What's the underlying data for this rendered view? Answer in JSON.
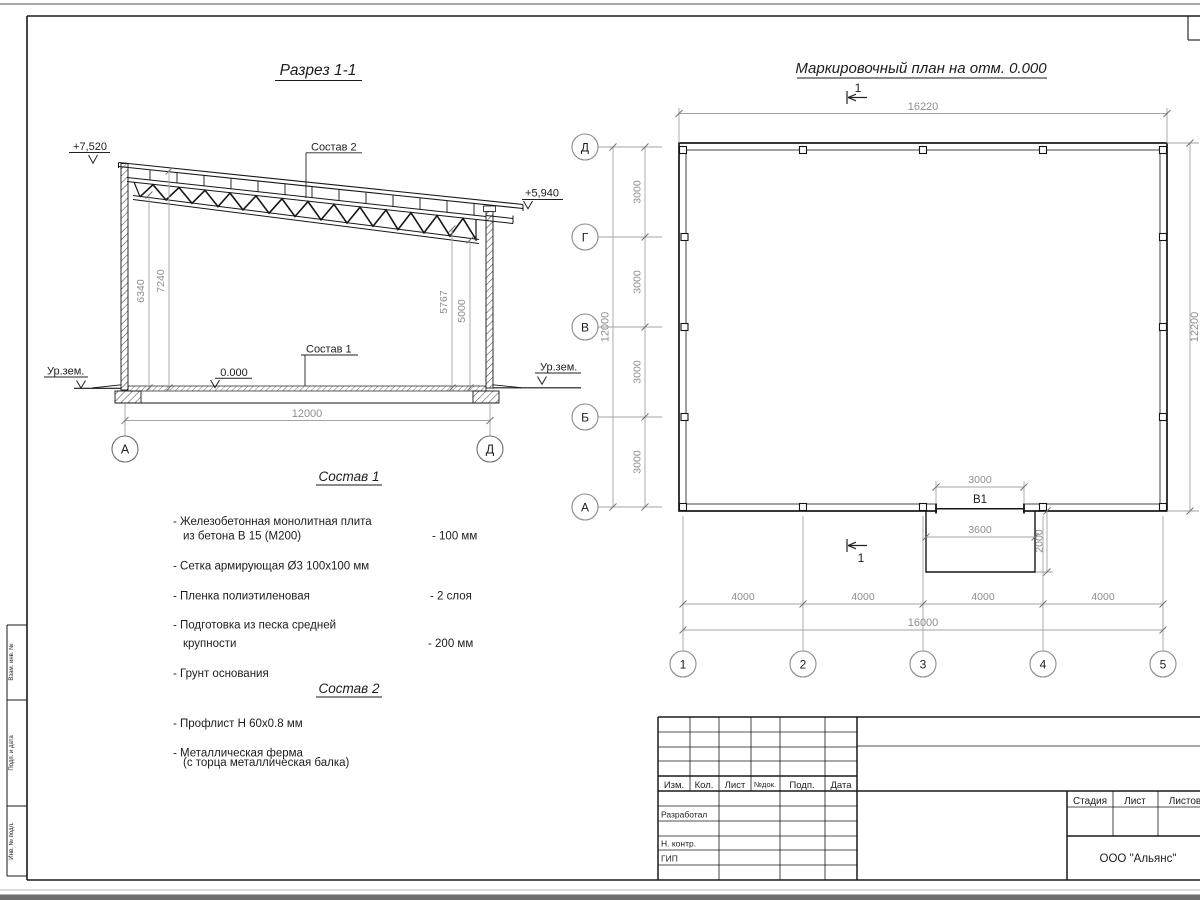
{
  "section_view": {
    "title": "Разрез 1-1",
    "level_top_left": "+7,520",
    "level_top_right": "+5,940",
    "level_floor": "0.000",
    "ground_label_left": "Ур.зем.",
    "ground_label_right": "Ур.зем.",
    "callout_roof": "Состав 2",
    "callout_floor": "Состав 1",
    "dim_h_left_1": "6340",
    "dim_h_left_2": "7240",
    "dim_h_right_1": "5767",
    "dim_h_right_2": "5000",
    "dim_span": "12000",
    "axis_left": "А",
    "axis_right": "Д"
  },
  "plan_view": {
    "title": "Маркировочный план на отм. 0.000",
    "section_mark_top": "1",
    "section_mark_bottom": "1",
    "dim_top_total": "16220",
    "dim_right_total": "12200",
    "dim_left_total": "12000",
    "dim_bottom_total": "16000",
    "row_axes": [
      "Д",
      "Г",
      "В",
      "Б",
      "А"
    ],
    "col_axes": [
      "1",
      "2",
      "3",
      "4",
      "5"
    ],
    "row_steps": [
      "3000",
      "3000",
      "3000",
      "3000"
    ],
    "col_steps": [
      "4000",
      "4000",
      "4000",
      "4000"
    ],
    "opening_label": "В1",
    "opening_dim": "3000",
    "porch_width": "3600",
    "porch_depth": "2000"
  },
  "notes": {
    "composition1": {
      "title": "Состав 1",
      "items": [
        {
          "line1": "- Железобетонная  монолитная плита",
          "line2": "из бетона В 15 (М200)",
          "value": "- 100 мм"
        },
        {
          "line1": "- Сетка армирующая Ø3 100х100 мм",
          "line2": "",
          "value": ""
        },
        {
          "line1": "- Пленка полиэтиленовая",
          "line2": "",
          "value": "-  2 слоя"
        },
        {
          "line1": "- Подготовка из песка средней",
          "line2": "крупности",
          "value": "- 200 мм"
        },
        {
          "line1": "- Грунт основания",
          "line2": "",
          "value": ""
        }
      ]
    },
    "composition2": {
      "title": "Состав 2",
      "items": [
        {
          "line1": "- Профлист Н 60х0.8 мм",
          "line2": ""
        },
        {
          "line1": "- Металлическая ферма",
          "line2": "(с торца металлическая балка)"
        }
      ]
    }
  },
  "title_block": {
    "rev_headers": [
      "Изм.",
      "Кол.",
      "Лист",
      "№док.",
      "Подп.",
      "Дата"
    ],
    "role_rows": [
      "Разработал",
      "Н. контр.",
      "ГИП"
    ],
    "stage_headers": [
      "Стадия",
      "Лист",
      "Листов"
    ],
    "company": "ООО \"Альянс\""
  },
  "frame_margin": {
    "labels": [
      "Взам. инв. №",
      "Подп. и дата",
      "Инв. № подл."
    ]
  }
}
